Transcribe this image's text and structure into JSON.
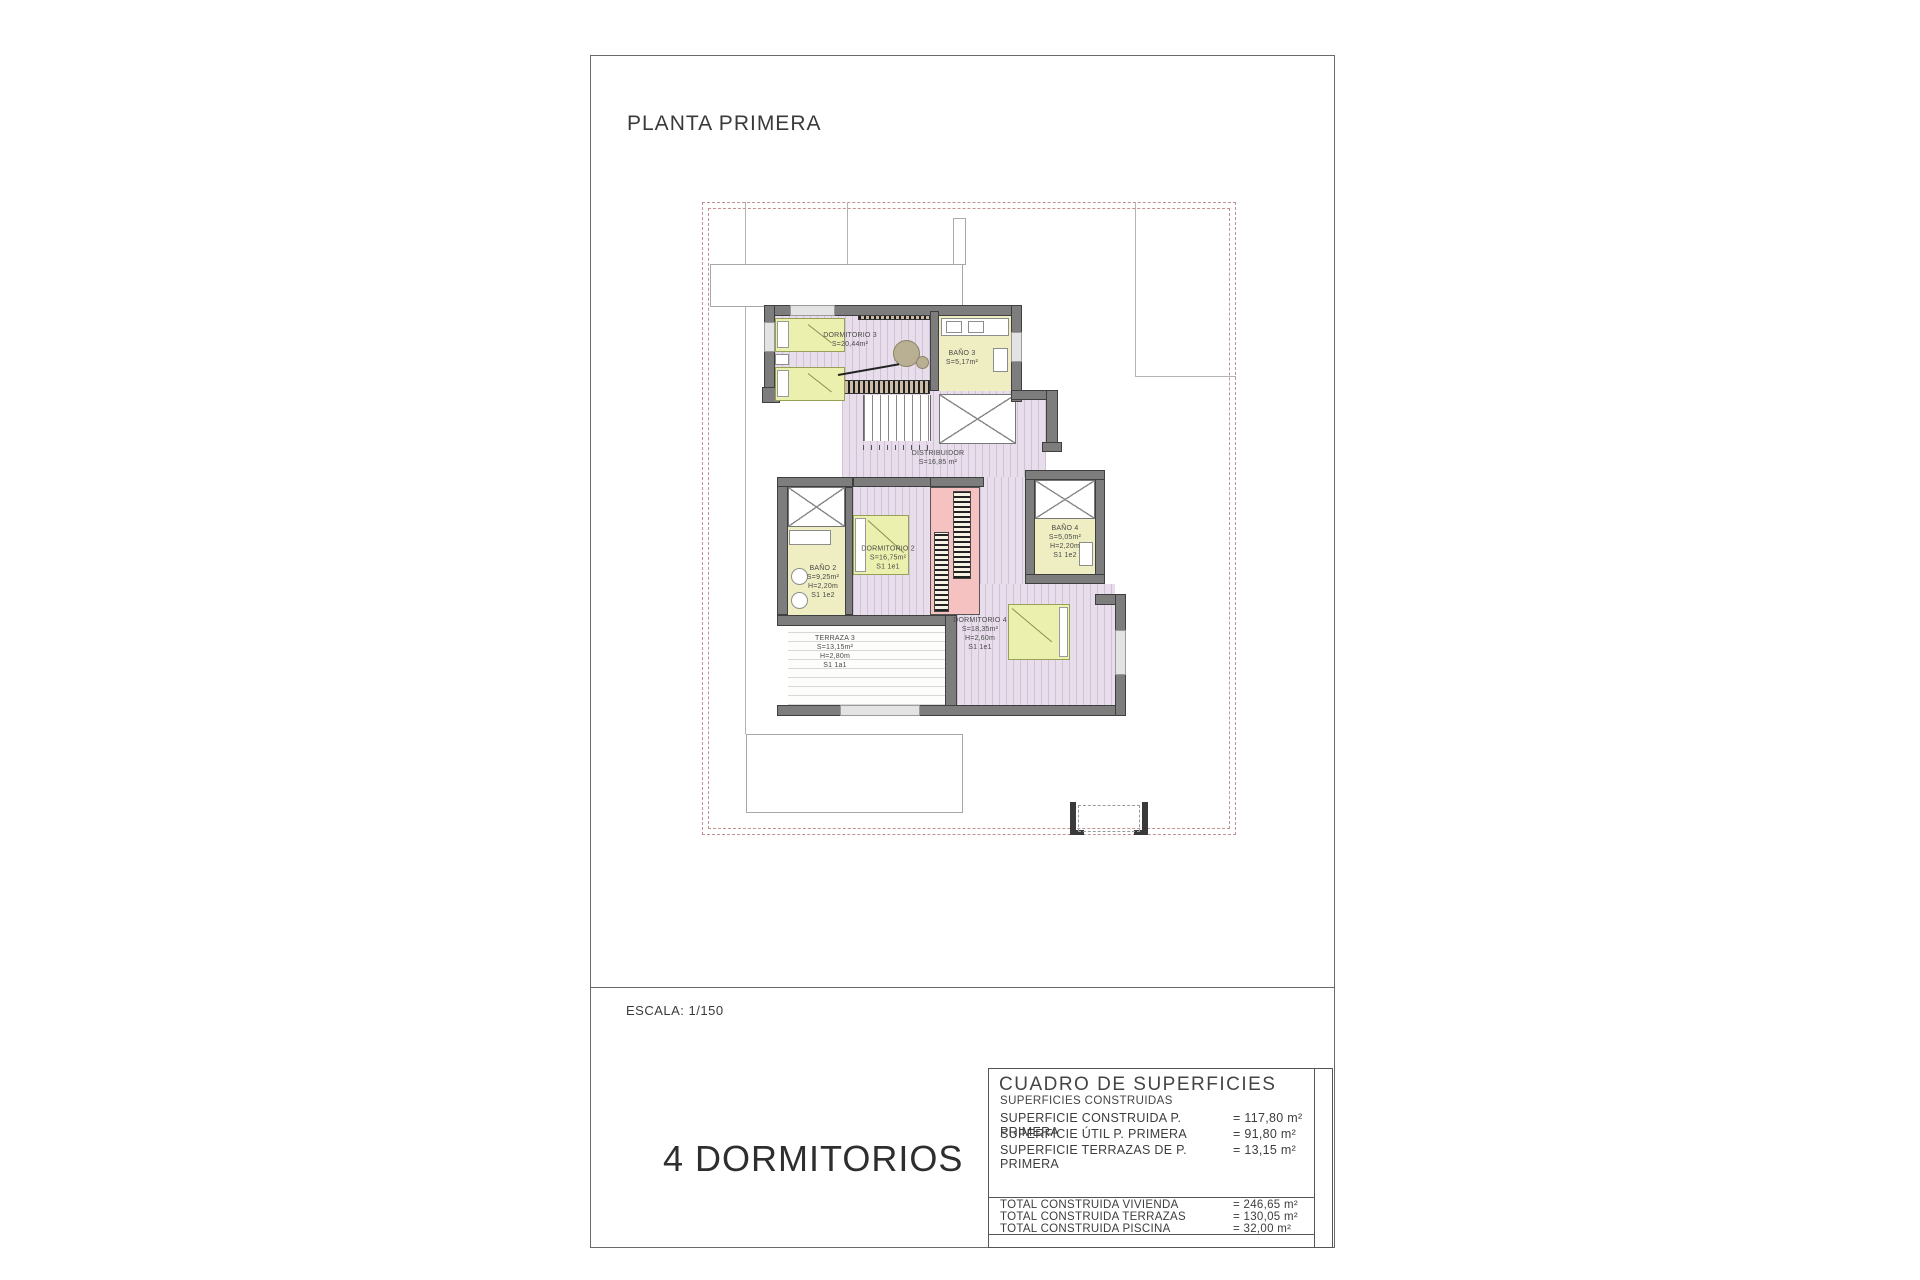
{
  "page": {
    "title": "PLANTA PRIMERA",
    "scale_label": "ESCALA: 1/150",
    "bedrooms_label": "4 DORMITORIOS"
  },
  "plan": {
    "rooms": {
      "dormitorio3": {
        "name": "DORMITORIO 3",
        "area": "S=20,44m²"
      },
      "bano3": {
        "name": "BAÑO 3",
        "area": "S=5,17m²"
      },
      "distribuidor": {
        "name": "DISTRIBUIDOR",
        "area": "S=16,85 m²"
      },
      "dormitorio2": {
        "name": "DORMITORIO 2",
        "area": "S=16,75m²",
        "ref": "S1 1e1"
      },
      "bano2": {
        "name": "BAÑO 2",
        "area": "S=9,25m²",
        "height": "H=2,20m",
        "ref": "S1 1e2"
      },
      "bano4": {
        "name": "BAÑO 4",
        "area": "S=5,05m²",
        "height": "H=2,20m",
        "ref": "S1 1e2"
      },
      "dormitorio4": {
        "name": "DORMITORIO 4",
        "area": "S=18,35m²",
        "height": "H=2,60m",
        "ref": "S1 1e1"
      },
      "terraza3": {
        "name": "TERRAZA 3",
        "area": "S=13,15m²",
        "height": "H=2,80m",
        "ref": "S1 1a1"
      }
    }
  },
  "table": {
    "title": "CUADRO DE SUPERFICIES",
    "subtitle": "SUPERFICIES CONSTRUIDAS",
    "rows": [
      {
        "label": "SUPERFICIE CONSTRUIDA P. PRIMERA",
        "value": "= 117,80 m²"
      },
      {
        "label": "SUPERFICIE ÚTIL P. PRIMERA",
        "value": "= 91,80 m²"
      },
      {
        "label": "SUPERFICIE TERRAZAS DE P. PRIMERA",
        "value": "= 13,15 m²"
      }
    ],
    "totals": [
      {
        "label": "TOTAL CONSTRUIDA VIVIENDA",
        "value": "= 246,65 m²"
      },
      {
        "label": "TOTAL CONSTRUIDA TERRAZAS",
        "value": "= 130,05 m²"
      },
      {
        "label": "TOTAL CONSTRUIDA PISCINA",
        "value": "= 32,00 m²"
      }
    ]
  },
  "colors": {
    "floor_lavender": "#e7ddeb",
    "room_yellow": "#efeec2",
    "bed_green": "#ebf0ae",
    "wall_gray": "#7d7d7d",
    "stair_pink": "#f5c1c1",
    "boundary_dash": "#c49292",
    "line_gray": "#b3b3b3",
    "text_dark": "#3d3d3d"
  }
}
